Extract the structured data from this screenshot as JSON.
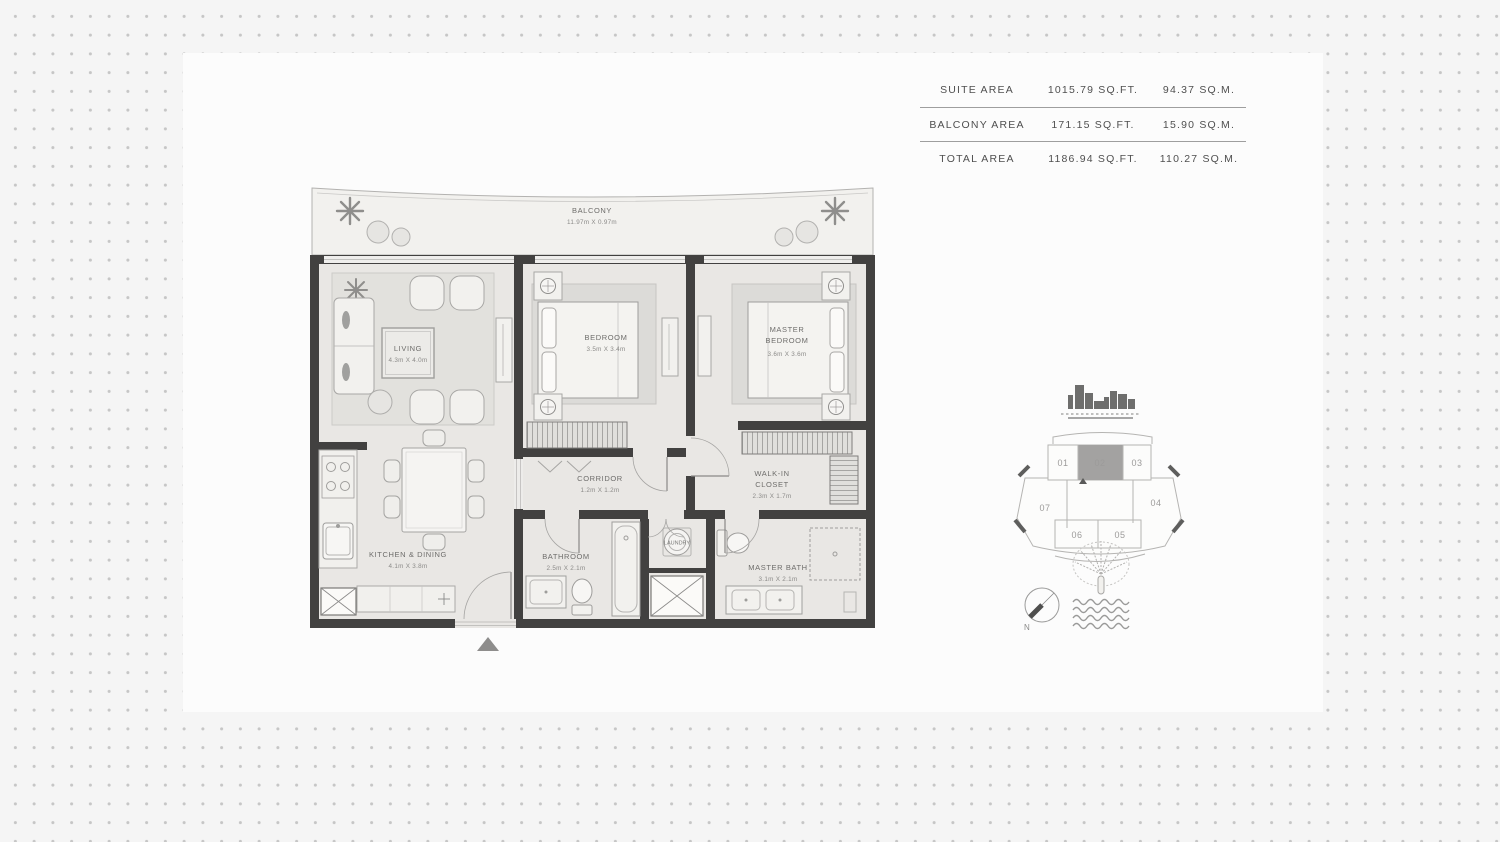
{
  "area_table": {
    "rows": [
      {
        "label": "SUITE AREA",
        "sqft": "1015.79 SQ.FT.",
        "sqm": "94.37 SQ.M."
      },
      {
        "label": "BALCONY AREA",
        "sqft": "171.15 SQ.FT.",
        "sqm": "15.90 SQ.M."
      },
      {
        "label": "TOTAL AREA",
        "sqft": "1186.94 SQ.FT.",
        "sqm": "110.27 SQ.M."
      }
    ]
  },
  "floorplan": {
    "balcony": {
      "name": "BALCONY",
      "dims": "11.97m X 0.97m"
    },
    "living": {
      "name": "LIVING",
      "dims": "4.3m X 4.0m"
    },
    "bedroom": {
      "name": "BEDROOM",
      "dims": "3.5m X 3.4m"
    },
    "master_bedroom": {
      "line1": "MASTER",
      "line2": "BEDROOM",
      "dims": "3.6m X 3.6m"
    },
    "corridor": {
      "name": "CORRIDOR",
      "dims": "1.2m X 1.2m"
    },
    "walk_in_closet": {
      "line1": "WALK-IN",
      "line2": "CLOSET",
      "dims": "2.3m X 1.7m"
    },
    "kitchen": {
      "name": "KITCHEN & DINING",
      "dims": "4.1m X 3.8m"
    },
    "bathroom": {
      "name": "BATHROOM",
      "dims": "2.5m X 2.1m"
    },
    "laundry": {
      "name": "LAUNDRY"
    },
    "master_bath": {
      "name": "MASTER BATH",
      "dims": "3.1m X 2.1m"
    }
  },
  "key_plan": {
    "units": {
      "u01": "01",
      "u02": "02",
      "u03": "03",
      "u04": "04",
      "u05": "05",
      "u06": "06",
      "u07": "07"
    },
    "highlighted": "02",
    "compass": "N"
  },
  "colors": {
    "wall": "#424140",
    "floor": "#e9e7e4",
    "balcony_floor": "#f2f1ee",
    "unit_highlight": "#a3a2a1",
    "dot": "#c6c6c6"
  }
}
